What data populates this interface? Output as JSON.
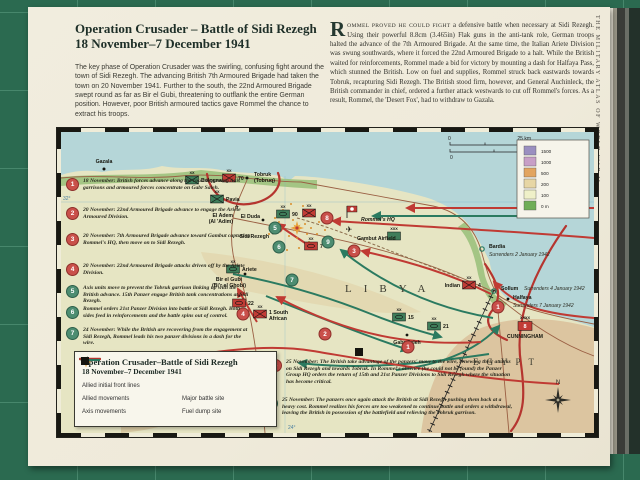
{
  "colors": {
    "allied_red": "#c03a33",
    "axis_green": "#2b7a60",
    "sea": "#b5d6d8",
    "land": "#e6e5c3",
    "mat_green": "#2b6a50",
    "front_red": "#b5352f"
  },
  "page": {
    "sidebar_vertical": "THE MILITARY ATLAS OF WORLD WAR II",
    "title_line1": "Operation Crusader – Battle of Sidi Rezegh",
    "title_line2": "18 November–7 December 1941",
    "intro": "The key phase of Operation Crusader was the swirling, confusing fight around the town of Sidi Rezegh. The advancing British 7th Armoured Brigade had taken the town on 20 November 1941. Further to the south, the 22nd Armoured Brigade swept round as far as Bir el Gubi, threatening to outflank the entire German position. However, poor British armoured tactics gave Rommel the chance to extract his troops.",
    "body_dropcap": "R",
    "body_smallcaps": "OMMEL PROVED HE COULD FIGHT",
    "body_rest": " a defensive battle when necessary at Sidi Rezegh. Using their powerful 8.8cm (3.465in) Flak guns in the anti-tank role, German troops halted the advance of the 7th Armoured Brigade. At the same time, the Italian Ariete Division was swung southwards, where it forced the 22nd Armoured Brigade to a halt. While the British waited for reinforcements, Rommel made a bid for victory by mounting a dash for Halfaya Pass, which stunned the British. Low on fuel and supplies, Rommel struck back eastwards towards Tobruk, recapturing Sidi Rezegh. The British stood firm, however, and General Auchinleck, the British commander in chief, ordered a further attack westwards to cut off Rommel's forces. As a result, Rommel, the 'Desert Fox', had to withdraw to Gazala."
  },
  "map": {
    "legendbox": {
      "title1": "Operation Crusader–Battle of Sidi Rezegh",
      "title2": "18 November–7 December 1941",
      "entries": [
        "Allied initial front lines",
        "Allied movements",
        "Axis movements",
        "Major battle site",
        "Fuel dump site"
      ]
    },
    "scale": {
      "km0": "0",
      "km": "25 km",
      "mi0": "0",
      "mi": "25 miles"
    },
    "elevation": [
      {
        "c": "#9a8fc0",
        "v": "1500"
      },
      {
        "c": "#c79fc6",
        "v": "1000"
      },
      {
        "c": "#e2a45e",
        "v": "500"
      },
      {
        "c": "#e7d6a4",
        "v": "200"
      },
      {
        "c": "#eff0c8",
        "v": "100"
      },
      {
        "c": "#6fae57",
        "v": "0 m"
      }
    ],
    "geo": {
      "libya": "LIBYA",
      "egypt": "EGYPT",
      "lat": "32°",
      "lon": "24°",
      "north": "N"
    },
    "icons": {
      "plane": "✈"
    },
    "towns": {
      "gazala": {
        "name": "Gazala"
      },
      "tobruk": {
        "name": "Tobruk",
        "alt": "(Tobruq)"
      },
      "el_adem": {
        "name": "El Adem",
        "alt": "(Al 'Adim)"
      },
      "el_duda": {
        "name": "El Duda"
      },
      "sidi_rezegh": {
        "name": "Sidi Rezegh"
      },
      "bir_el_gubi": {
        "name": "Bir el Gubi",
        "alt": "(Bi'r el Ghobi)"
      },
      "gabr_saleh": {
        "name": "Gabr Saleh"
      },
      "bardia": {
        "name": "Bardia",
        "note": "Surrenders 2 January 1942"
      },
      "sollum": {
        "name": "Sollum",
        "note": "Surrenders 4 January 1942"
      },
      "halfaya": {
        "name": "Halfaya",
        "note": "Surrenders 7 January 1942"
      },
      "rommels_hq": {
        "name": "Rommel's HQ"
      },
      "gambut": {
        "name": "Gambut Airfield"
      },
      "cunningham": {
        "name": "CUNNINGHAM"
      }
    },
    "units": {
      "bologna": {
        "echelon": "XX",
        "label": "Bologna"
      },
      "seventy": {
        "echelon": "XX",
        "label": "70"
      },
      "pavia": {
        "echelon": "XX",
        "label": "Pavia"
      },
      "ninety": {
        "echelon": "XX",
        "label": "90"
      },
      "nz": {
        "echelon": "XX",
        "label": ""
      },
      "seven": {
        "echelon": "XX",
        "label": "7"
      },
      "ariete": {
        "echelon": "XX",
        "label": "Ariete"
      },
      "twentytwo": {
        "echelon": "X",
        "label": "22"
      },
      "sa": {
        "echelon": "XX",
        "label_l1": "1 South",
        "label_l2": "African"
      },
      "fifteen": {
        "echelon": "XX",
        "label": "15"
      },
      "twentyone": {
        "echelon": "XX",
        "label": "21"
      },
      "indian": {
        "echelon": "XX",
        "label_left": "Indian",
        "label_right": "4"
      },
      "army8": {
        "echelon": "XXXX",
        "inside": "8"
      },
      "gambut_corps": {
        "echelon": "XXX"
      }
    },
    "marker_labels": [
      "1",
      "1",
      "2",
      "3",
      "4",
      "5",
      "6",
      "7",
      "8",
      "9"
    ],
    "notes": [
      {
        "n": "1",
        "text": "18 November: British forces advance along the coast bypassing Axis garrisons and armoured forces concentrate on Gabr Saleh."
      },
      {
        "n": "2",
        "text": "20 November: 22nd Armoured Brigade advance to engage the Ariete Armoured Division."
      },
      {
        "n": "3",
        "text": "20 November: 7th Armoured Brigade advance toward Gambut capturing Rommel's HQ, then move on to Sidi Rezegh."
      },
      {
        "n": "4",
        "text": "20 November: 22nd Armoured Brigade attacks driven off by the Ariete Division."
      },
      {
        "n": "5",
        "text": "Axis units move to prevent the Tobruk garrison linking up with the British advance. 15th Panzer engage British tank concentrations at Sidi Rezegh."
      },
      {
        "n": "6",
        "text": "Rommel orders 21st Panzer Division into battle at Sidi Rezegh. Both sides feed in reinforcements and the battle spins out of control."
      },
      {
        "n": "7",
        "text": "24 November: While the British are recovering from the engagement at Sidi Rezegh, Rommel leads his two panzer divisions in a dash for the wire."
      },
      {
        "n": "8",
        "text": "25 November: The British take advantage of the panzers' move to the wire, renewing their attacks on Sidi Rezegh and towards Tobruk. In Rommel's absence (he could not be found) the Panzer Group HQ orders the return of 15th and 21st Panzer Divisions to Sidi Rezegh where the situation has become critical."
      },
      {
        "n": "9",
        "text": "25 November: The panzers once again attack the British at Sidi Rezegh pushing them back at a heavy cost. Rommel realizes his forces are too weakened to continue battle and orders a withdrawal, leaving the British in possession of the battlefield and relieving the Tobruk garrison."
      }
    ]
  }
}
